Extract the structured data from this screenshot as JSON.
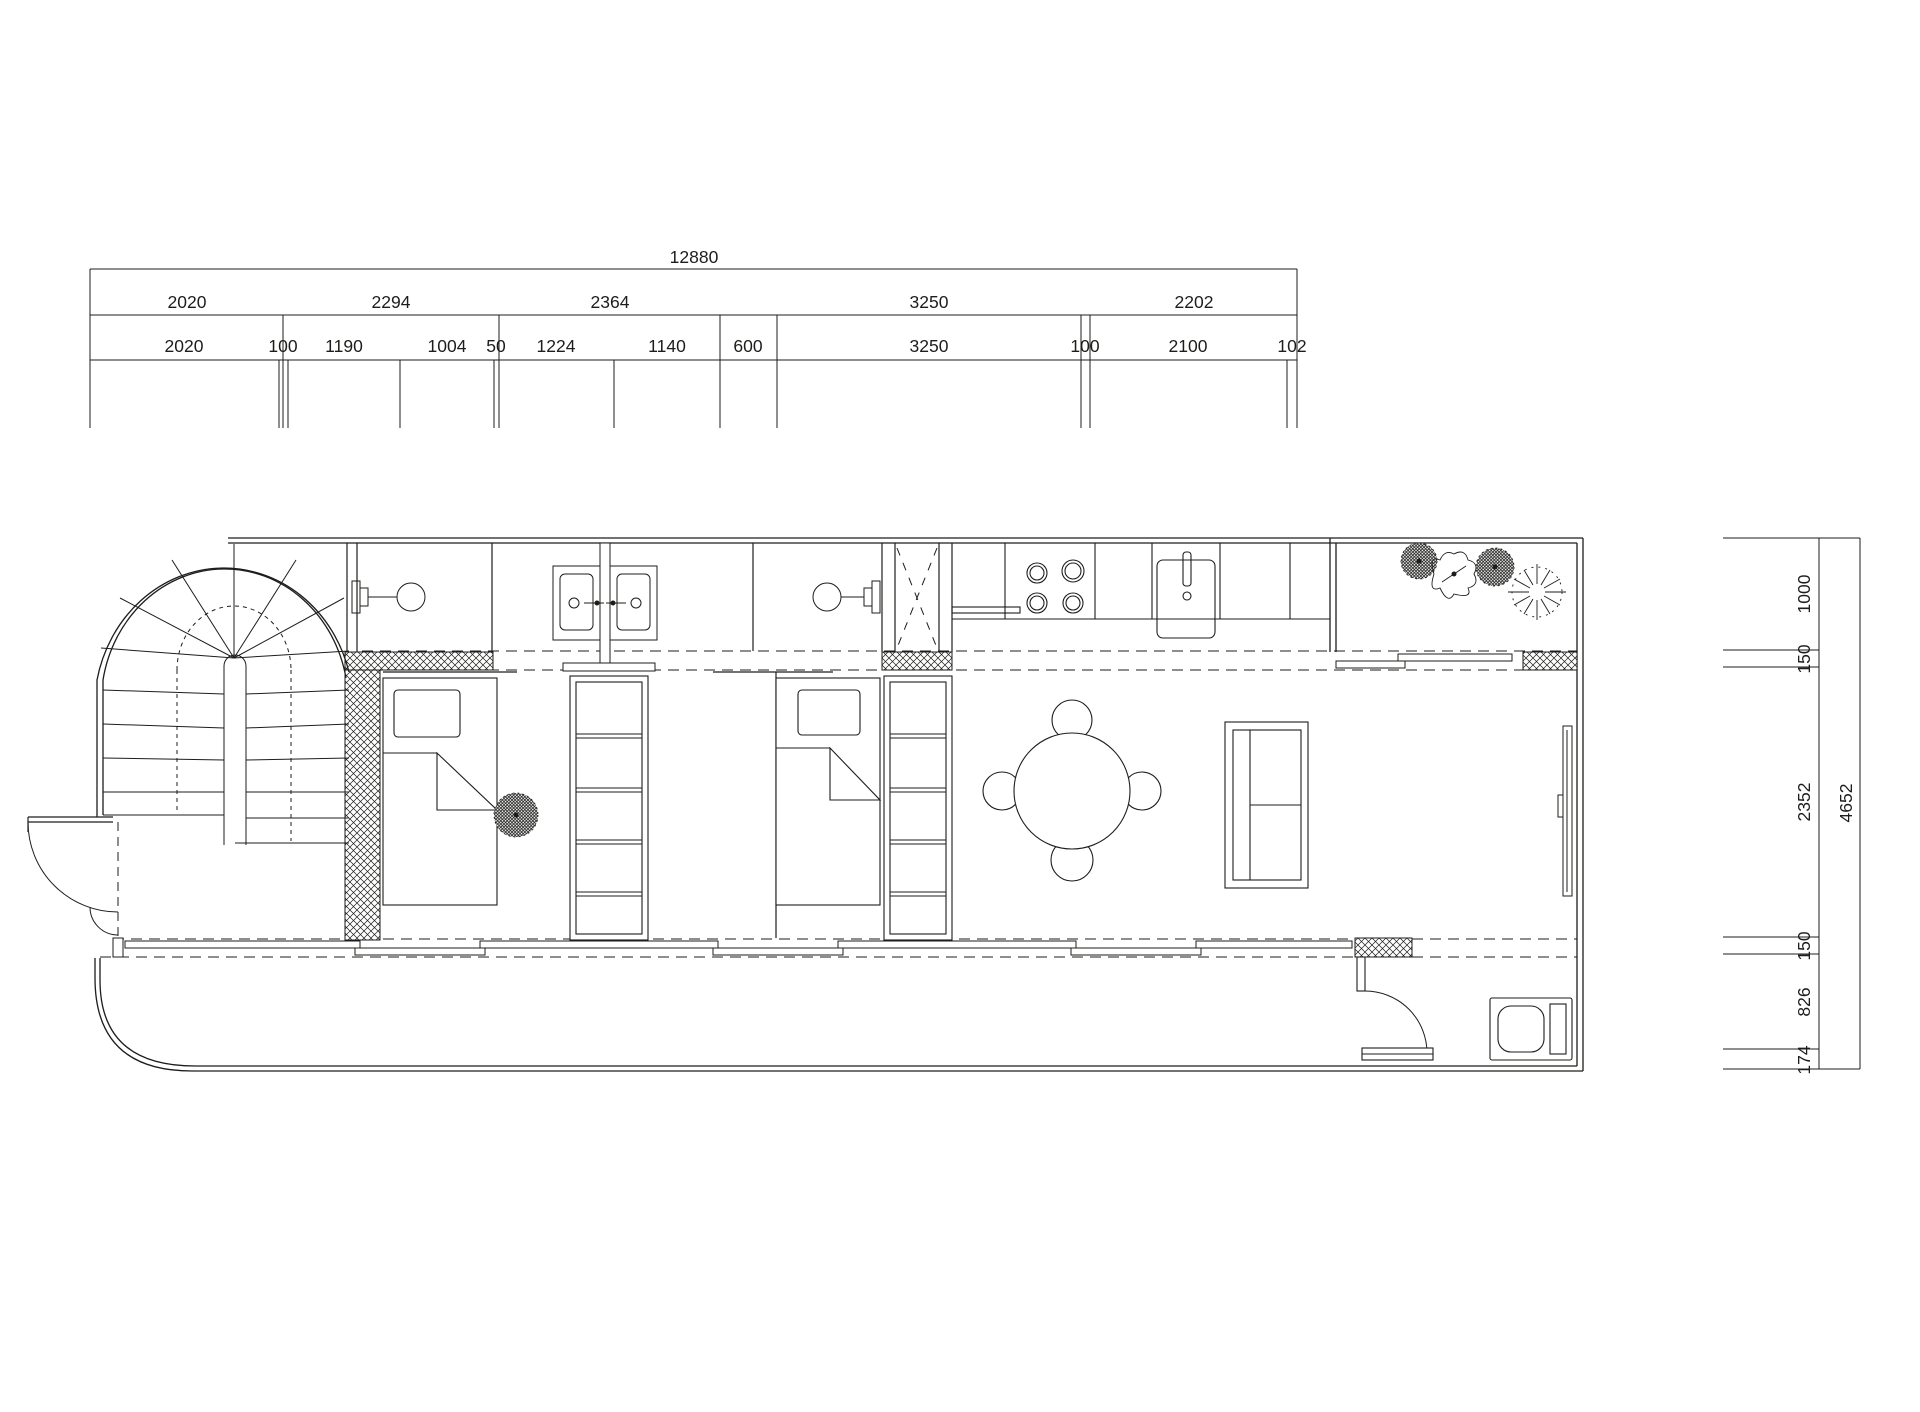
{
  "colors": {
    "background": "#ffffff",
    "line": "#1d1d1b"
  },
  "dimensions": {
    "top": {
      "total": "12880",
      "major": [
        "2020",
        "2294",
        "2364",
        "3250",
        "2202"
      ],
      "minor": [
        "2020",
        "100",
        "1190",
        "1004",
        "50",
        "1224",
        "1140",
        "600",
        "3250",
        "100",
        "2100",
        "102"
      ]
    },
    "right": {
      "total": "4652",
      "segments": [
        "1000",
        "150",
        "2352",
        "150",
        "826",
        "174"
      ]
    }
  },
  "symbols": [
    "spiral-staircase",
    "entry-double-door",
    "wall-lamp",
    "double-sink-vanity",
    "wardrobe-shelves",
    "single-bed",
    "service-shaft",
    "cooktop-4-burner",
    "kitchen-sink",
    "dining-table-4-chairs",
    "sofa",
    "sliding-door",
    "terrace-plants",
    "indoor-plant",
    "toilet",
    "deck-outline"
  ]
}
